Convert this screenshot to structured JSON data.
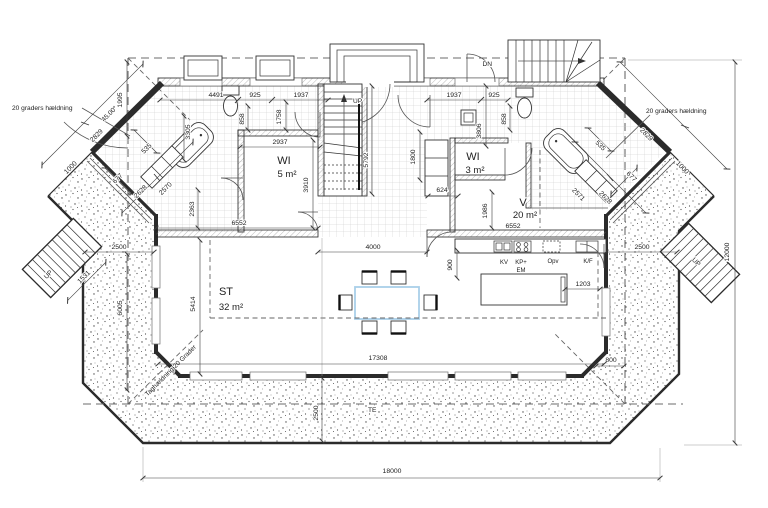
{
  "rooms": {
    "wi5": {
      "name": "WI",
      "area": "5 m²"
    },
    "wi3": {
      "name": "WI",
      "area": "3 m²"
    },
    "v": {
      "name": "V",
      "area": "20 m²"
    },
    "st": {
      "name": "ST",
      "area": "32 m²"
    }
  },
  "annotations": {
    "slope_left": "20 graders hældning",
    "slope_right": "20 graders hældning",
    "roof_diag": "Taghældning 20 Grader",
    "angle": "45.00°",
    "te": "TE",
    "up_left": "UP",
    "up_center": "UP",
    "up_right": "UP",
    "dn_top": "DN"
  },
  "kitchen": {
    "kv": "KV",
    "kp": "KP+",
    "em": "EM",
    "opv": "Opv",
    "kf": "K/F"
  },
  "dims": {
    "a4491": "4491",
    "a925L": "925",
    "a1937L": "1937",
    "a1937R": "1937",
    "a925R": "925",
    "a858L": "858",
    "a1758": "1758",
    "a2937": "2937",
    "a3910": "3910",
    "a3305": "3305",
    "a2363": "2363",
    "a5792": "5792",
    "a858R": "858",
    "a3806": "3806",
    "a1800": "1800",
    "a624": "624",
    "a1986": "1986",
    "a6552L": "6552",
    "a6552R": "6552",
    "a4000": "4000",
    "a900": "900",
    "a1203": "1203",
    "a800": "800",
    "a5414": "5414",
    "a17308": "17308",
    "a2500B": "2500",
    "a2500L": "2500",
    "a2500R": "2500",
    "a6005": "6005",
    "a1995": "1995",
    "a1531": "1531",
    "a12000": "12000",
    "a18000": "18000",
    "a2829L": "2829",
    "a1000L": "1000",
    "a535L": "535",
    "a677L": "677",
    "a2628L": "2628",
    "a2570L": "2570",
    "a2829R": "2829",
    "a1000R": "1000",
    "a535R": "535",
    "a677R": "677",
    "a2628R": "2628",
    "a2571R": "2571"
  },
  "colors": {
    "selection": "#a9cfe9",
    "line": "#2b2b2b"
  }
}
